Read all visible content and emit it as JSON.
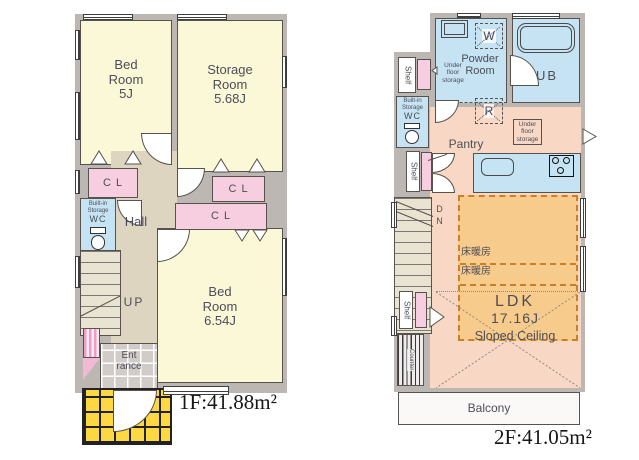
{
  "floor1": {
    "area_label": "1F:41.88m²",
    "bedroom_small": {
      "name": "Bed Room",
      "size": "5J"
    },
    "storage_room": {
      "name": "Storage Room",
      "size": "5.68J"
    },
    "closet_label": "C L",
    "wc": {
      "storage_label": "Built-in Storage",
      "label": "WC"
    },
    "hall_label": "Hall",
    "stairs_label": "UP",
    "bedroom_large": {
      "name": "Bed Room",
      "size": "6.54J"
    },
    "entrance_line1": "Ent",
    "entrance_line2": "rance"
  },
  "floor2": {
    "area_label": "2F:41.05m²",
    "washer_label": "W",
    "powder_room_label": "Powder Room",
    "bath_label": "UB",
    "under_floor_storage_label": "Under floor storage",
    "shelf_label": "Shelf",
    "wc": {
      "storage_label": "Built-in Storage",
      "label": "WC"
    },
    "pantry_label": "Pantry",
    "fridge_label": "R",
    "stairs_label": "DN",
    "floor_heating_label": "床暖房",
    "ldk": {
      "name": "LDK",
      "size": "17.16J",
      "note": "Sloped Ceiling"
    },
    "counter_label": "Counter",
    "balcony_label": "Balcony"
  },
  "colors": {
    "wall": "#bdb7b3",
    "room_yellow": "#fbf8d8",
    "closet_pink": "#f7cde0",
    "water_blue": "#c5e3f2",
    "hall_beige": "#ded5c0",
    "ldk_peach": "#f8d8c4",
    "floor_heat_orange": "#f7cb8b",
    "porch_yellow": "#fed843",
    "outline": "#57524d"
  }
}
